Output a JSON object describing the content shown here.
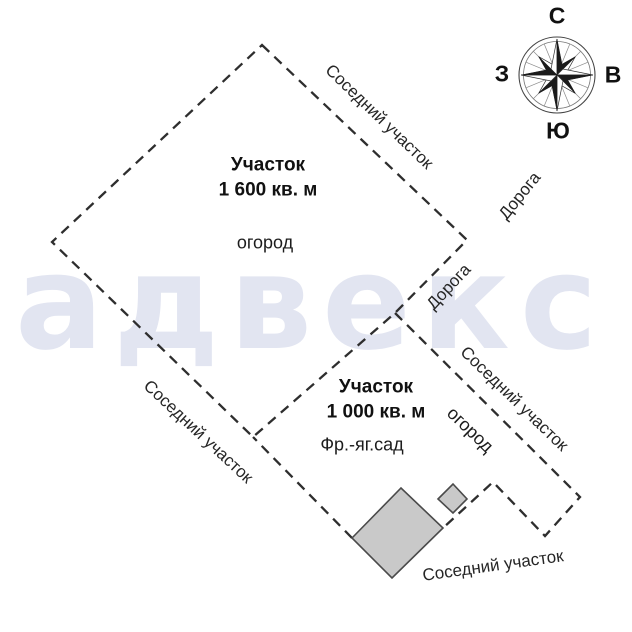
{
  "watermark": {
    "text": "адвекс"
  },
  "compass": {
    "north": "С",
    "east": "В",
    "south": "Ю",
    "west": "З"
  },
  "plot1": {
    "title": "Участок",
    "area": "1 600 кв. м",
    "feature": "огород"
  },
  "plot2": {
    "title": "Участок",
    "area": "1 000 кв. м",
    "feature_garden": "Фр.-яг.сад",
    "feature_vegetable": "огород"
  },
  "labels": {
    "neighbor_top_right": "Соседний участок",
    "neighbor_bottom_left": "Соседний участок",
    "neighbor_right": "Соседний участок",
    "neighbor_bottom": "Соседний участок",
    "road_upper": "Дорога",
    "road_lower": "Дорога"
  },
  "colors": {
    "boundary_dash": "#2e2e2e",
    "building_fill": "#c9c9c9",
    "building_stroke": "#4a4a4a",
    "watermark": "#e2e5f1"
  }
}
